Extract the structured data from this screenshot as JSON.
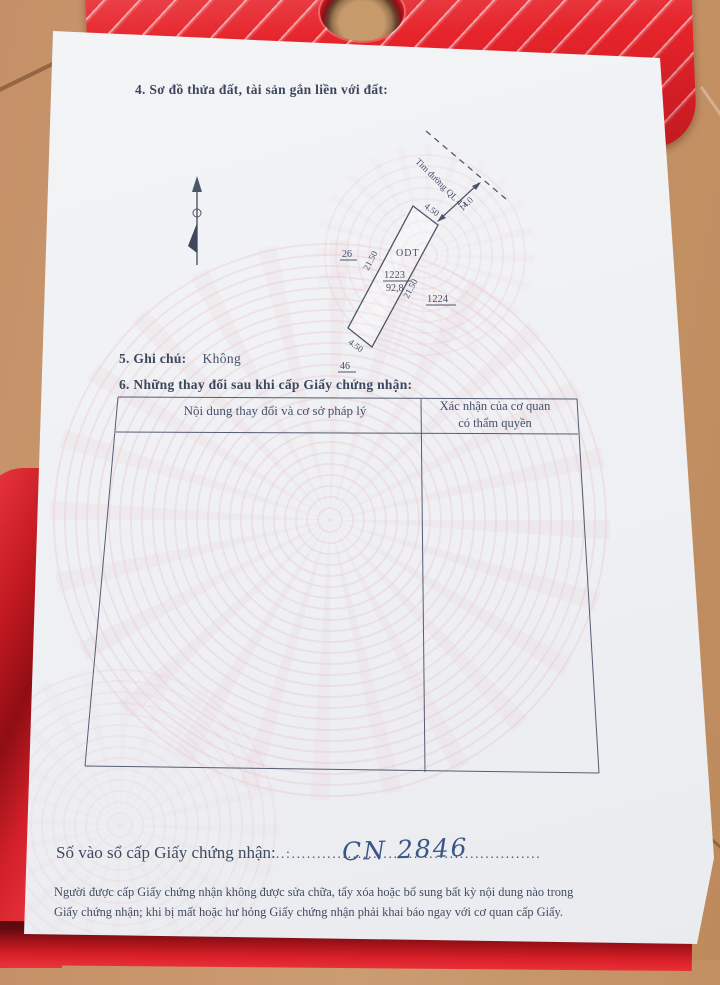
{
  "document": {
    "section4_heading": "4. Sơ đồ thửa đất, tài sản gắn liền với đất:",
    "diagram": {
      "road_label": "Tim đường QL 47",
      "distance_to_road": "14.0",
      "parcel_code": "ODT",
      "parcel_number": "1223",
      "parcel_area": "92,8",
      "dim_top": "4.50",
      "dim_left": "21.50",
      "dim_right": "21.50",
      "dim_bottom": "4.50",
      "neighbor_left": "26",
      "neighbor_right": "1224",
      "neighbor_bottom": "46"
    },
    "section5_label": "5. Ghi chú:",
    "section5_value": "Không",
    "section6_heading": "6. Những thay đổi sau khi cấp Giấy chứng nhận:",
    "table": {
      "col1_header": "Nội dung thay đổi và cơ sở pháp lý",
      "col2_header_line1": "Xác nhận của cơ quan",
      "col2_header_line2": "có thẩm quyền"
    },
    "registry_label": "Số vào sổ cấp Giấy chứng nhận:",
    "registry_dots": "..:.................................................",
    "registry_number": "CN 2846",
    "notice_line1": "Người được cấp Giấy chứng nhận không được sửa chữa, tẩy xóa hoặc bổ sung bất kỳ nội dung nào trong",
    "notice_line2": "Giấy chứng nhận; khi bị mất hoặc hư hỏng Giấy chứng nhận phải khai báo ngay với cơ quan cấp Giấy."
  },
  "colors": {
    "stool_red": "#e6242b",
    "floor_tan": "#c59067",
    "paper": "#eff1f4",
    "ink": "#414b61",
    "handwriting_ink": "#3a5685",
    "watermark_pink": "#e7b6c0"
  },
  "icons": {
    "north_arrow": "north-arrow"
  }
}
